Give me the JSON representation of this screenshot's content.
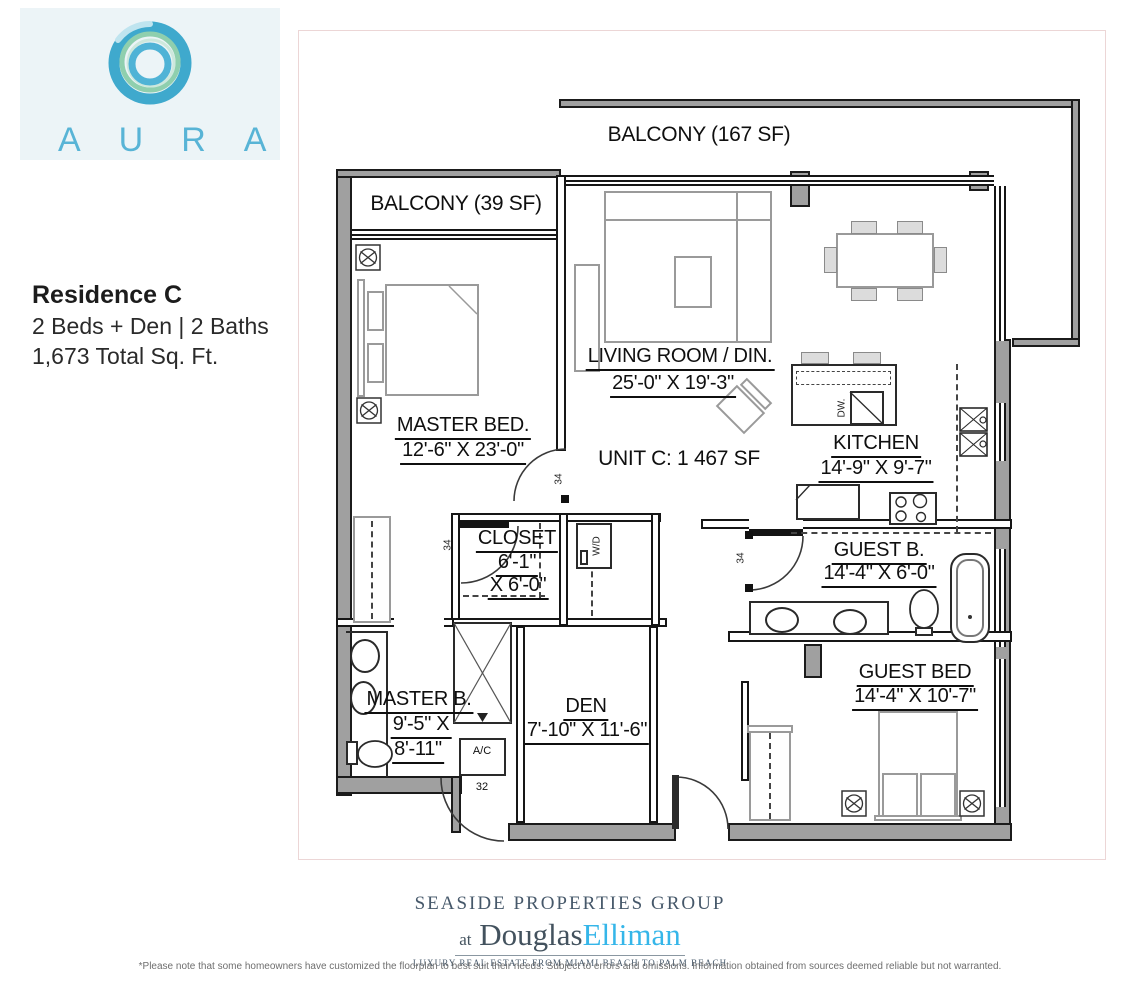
{
  "logo": {
    "name": "AURA"
  },
  "residence": {
    "title": "Residence C",
    "beds_baths": "2 Beds + Den  |  2 Baths",
    "sqft": "1,673 Total Sq. Ft."
  },
  "plan": {
    "unit_label": "UNIT C: 1 467 SF",
    "balcony_large": "BALCONY (167 SF)",
    "balcony_small": "BALCONY (39 SF)",
    "rooms": {
      "master_bed": {
        "name": "MASTER BED.",
        "dims": "12'-6\" X 23'-0\""
      },
      "living": {
        "name": "LIVING ROOM / DIN.",
        "dims": "25'-0\" X 19'-3\""
      },
      "kitchen": {
        "name": "KITCHEN",
        "dims": "14'-9\" X 9'-7\""
      },
      "closet": {
        "name": "CLOSET",
        "dims1": "6'-1\"",
        "dims2": "X 6'-0\""
      },
      "master_bath": {
        "name": "MASTER B.",
        "dims1": "9'-5\" X",
        "dims2": "8'-11\""
      },
      "den": {
        "name": "DEN",
        "dims": "7'-10\" X 11'-6\""
      },
      "guest_bath": {
        "name": "GUEST B.",
        "dims": "14'-4\" X 6'-0\""
      },
      "guest_bed": {
        "name": "GUEST BED",
        "dims": "14'-4\" X 10'-7\""
      }
    },
    "annotations": {
      "door_number": "34",
      "entry_number": "32",
      "ac": "A/C",
      "wd": "W/D",
      "dw": "DW."
    }
  },
  "footer": {
    "group": "SEASIDE PROPERTIES GROUP",
    "at": "at",
    "douglas": "Douglas",
    "elliman": "Elliman",
    "tagline": "LUXURY REAL ESTATE FROM MIAMI BEACH TO PALM BEACH",
    "disclaimer": "*Please note that some homeowners have customized the floorplan to best suit their needs. Subject to errors and omissions. Information obtained from sources deemed reliable but not warranted."
  },
  "colors": {
    "aura_blue": "#58b4d6",
    "elliman_blue": "#35b6e9",
    "wall_gray": "#a0a0a0",
    "sheet_border_pink": "#ecd6d6"
  }
}
